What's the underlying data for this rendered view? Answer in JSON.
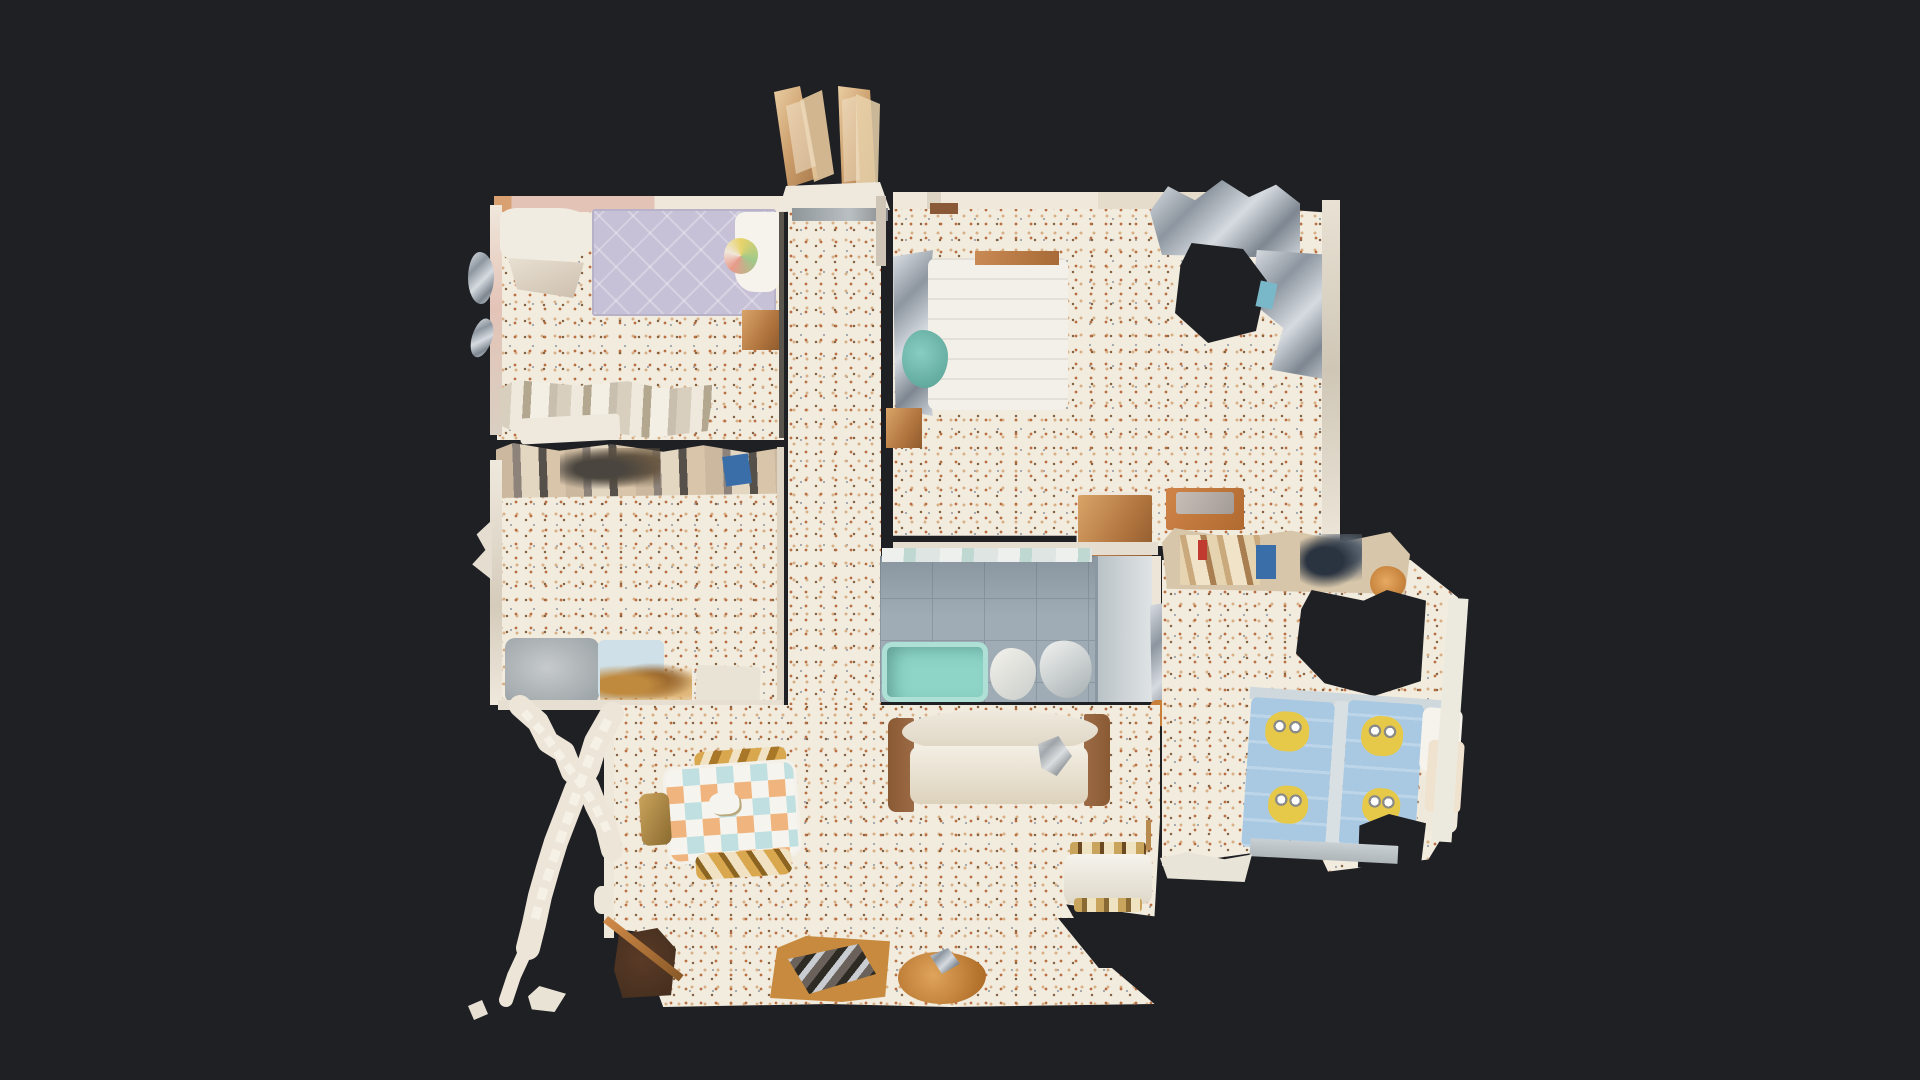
{
  "scene": {
    "type": "3d-scan-dollhouse-floorplan",
    "view": "top-down",
    "description": "Top-down dollhouse view of a photogrammetry-scanned apartment floating on a dark background; no visible UI chrome or text",
    "artifacts": [
      "unscanned-black-holes",
      "mesh-glitch-streaks",
      "partially-scanned-staircase-railing",
      "ragged-mesh-edges"
    ],
    "rooms": [
      {
        "id": "bedroom-top-left",
        "contents": [
          "lavender-quilted-double-bed",
          "white-wardrobe-top",
          "copper-nightstand",
          "glitched-dresser-row",
          "terrazzo-floor",
          "pink-walls"
        ]
      },
      {
        "id": "hallway",
        "contents": [
          "two-open-entrance-doors",
          "gray-lintel-beam",
          "terrazzo-floor",
          "red-door-edge"
        ]
      },
      {
        "id": "bedroom-top-right",
        "contents": [
          "white-double-bed",
          "teal-clothing",
          "chrome-wardrobe-glitch",
          "unscanned-hole",
          "copper-dresser",
          "orange-dresser",
          "copper-nightstand",
          "terrazzo-floor"
        ]
      },
      {
        "id": "bedroom-mid-left",
        "contents": [
          "cluttered-shelf-band",
          "blue-box",
          "gray-blurred-rug",
          "pale-blue-mat",
          "amber-clutter",
          "terrazzo-floor"
        ]
      },
      {
        "id": "bathroom",
        "contents": [
          "blue-gray-tile-floor",
          "teal-bathtub",
          "toilet",
          "bidet",
          "shower-section",
          "white-fixture-column"
        ]
      },
      {
        "id": "kids-bedroom",
        "contents": [
          "shelf-clutter-band",
          "blue-storage-box",
          "navy-clutter",
          "orange-bowl",
          "unscanned-hole",
          "white-wardrobe",
          "two-minion-themed-single-beds",
          "white-pillows",
          "cream-blanket",
          "terrazzo-floor"
        ]
      },
      {
        "id": "living-dining",
        "contents": [
          "checkered-tablecloth-dining-table",
          "gold-chairs",
          "beige-sofa-white-cushions",
          "white-armchair-striped-blanket",
          "dark-brown-cabinet",
          "amber-tv-sideboard",
          "amber-cabinet",
          "terrazzo-floor"
        ]
      },
      {
        "id": "staircase",
        "contents": [
          "jagged-white-railing-cross",
          "loose-mesh-scraps"
        ]
      }
    ]
  },
  "colors": {
    "bg": "#1f2024",
    "floor_terrazzo": "#f2ecdf",
    "speck_rust": "#b96f41",
    "speck_brown": "#7c5a3a",
    "speck_tan": "#d8ae84",
    "speck_gray": "#9aa0a8",
    "wall_light": "#ece5d8",
    "wall_pink": "#e4c3b7",
    "bed_lavender": "#c6c1d7",
    "bed_white": "#f3f0e9",
    "duvet_white": "#f6f3ec",
    "teal_cloth": "#89cdc1",
    "copper": "#c08a52",
    "amber": "#c78a3e",
    "dark_brown": "#47301f",
    "chrome_light": "#dfe3e7",
    "chrome_dark": "#8d96a0",
    "bath_tile": "#9fabb5",
    "bath_tile_line": "#8b98a2",
    "tub_teal": "#8ed5c8",
    "shower_gray": "#ccd2d5",
    "minion_blue": "#a9c9e3",
    "minion_yellow": "#e7c94a",
    "checker_aqua": "#bfdfe0",
    "checker_peach": "#f0b57f",
    "sofa_beige": "#ddd3c1",
    "sofa_frame": "#9c6b45",
    "red_accent": "#c0392b",
    "cream": "#efe3cf",
    "shelf_tan": "#d7c6aa",
    "box_blue": "#3a6ea8",
    "navy": "#2a3340",
    "door_tan": "#d0a275"
  }
}
